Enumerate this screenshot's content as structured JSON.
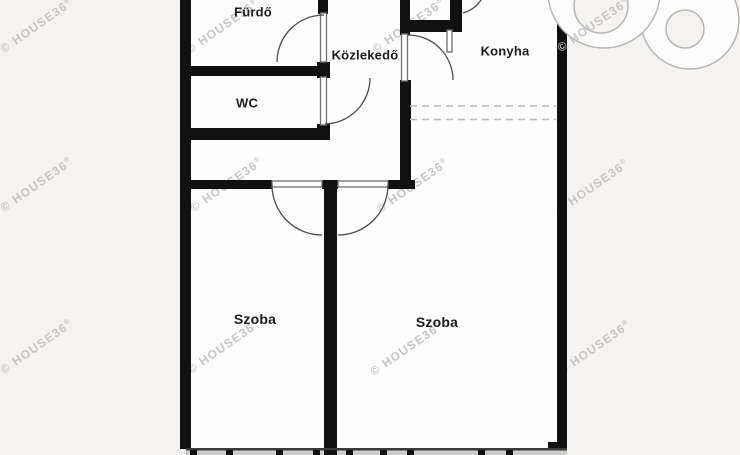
{
  "rooms": {
    "furdo": "Fürdő",
    "wc": "WC",
    "kozlekedo": "Közlekedő",
    "konyha": "Konyha",
    "szoba_left": "Szoba",
    "szoba_right": "Szoba"
  },
  "watermark": {
    "text": "© HOUSE36",
    "registered": "®"
  },
  "logo": {
    "icon": "house36-logo-icon"
  },
  "colors": {
    "background": "#f4f3f1",
    "room_fill": "#fdfdfd",
    "wall": "#111111",
    "door_arc": "#4c4c4c",
    "door_leaf_stroke": "#6e6e6e",
    "dashed_line": "#b9b9b8",
    "window_band": "#cdcdcc",
    "window_band_edge": "#3a3a3a",
    "watermark": "#c6c5c3",
    "logo_outline": "#b7b6b2"
  }
}
